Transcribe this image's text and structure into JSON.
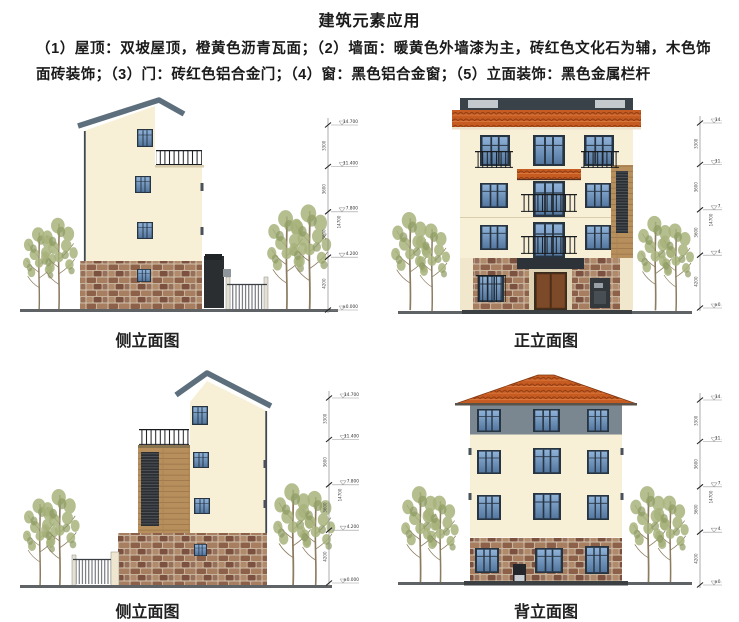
{
  "page": {
    "title": "建筑元素应用",
    "paragraph": "（1）屋顶：双坡屋顶，橙黄色沥青瓦面；（2）墙面：暖黄色外墙漆为主，砖红色文化石为辅，木色饰面砖装饰；（3）门：砖红色铝合金门；（4）窗：黑色铝合金窗；（5）立面装饰：黑色金属栏杆",
    "caption_note": ""
  },
  "figures": {
    "top_left": {
      "caption": "侧立面图"
    },
    "top_right": {
      "caption": "正立面图"
    },
    "bottom_left": {
      "caption": "侧立面图"
    },
    "bottom_right": {
      "caption": "背立面图"
    }
  },
  "dims": {
    "levels": [
      "14.700",
      "11.400",
      "7.800",
      "4.200",
      "±0.000"
    ],
    "segments": [
      "3300",
      "3600",
      "3600",
      "4200"
    ],
    "total": "14700"
  },
  "colors": {
    "wall_cream": "#f7efd6",
    "wall_cream_light": "#f4ebd1",
    "roof_tile_orange": "#c75c22",
    "roof_slate": "#5d6f7d",
    "stone_red_brown": "#8d6049",
    "wood_tan": "#b78f5c",
    "window_blue": "#5b80a9",
    "window_frame_black": "#273442",
    "railing_black": "#1a1d20",
    "ground_gray": "#5f6366",
    "parapet_dark": "#394249"
  }
}
